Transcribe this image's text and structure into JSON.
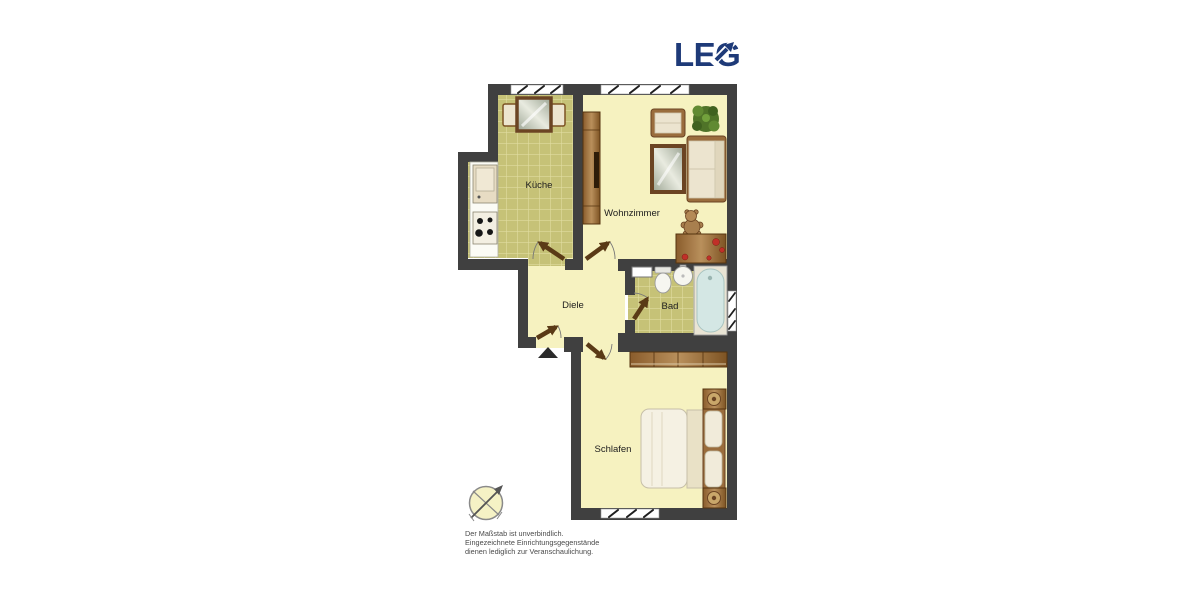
{
  "logo": {
    "text": "LEG",
    "color": "#1e3a78"
  },
  "floorplan": {
    "rooms": [
      {
        "id": "kueche",
        "label": "Küche"
      },
      {
        "id": "wohnzimmer",
        "label": "Wohnzimmer"
      },
      {
        "id": "diele",
        "label": "Diele"
      },
      {
        "id": "bad",
        "label": "Bad"
      },
      {
        "id": "schlafen",
        "label": "Schlafen"
      }
    ],
    "icons": {
      "compass": "north-arrow-compass-icon",
      "entrance": "entrance-direction-arrow"
    },
    "colors": {
      "wall": "#404040",
      "floor": "#f6f2c0",
      "tile_floor": "#c6c277",
      "tile_grid": "#e0dda0",
      "wood_dark": "#7d5323",
      "wood_light": "#b9905c",
      "door": "#5a3a16",
      "bathtub_water": "#d4e7e4",
      "plant_green": "#4f7328",
      "accent_red": "#c03028"
    }
  },
  "disclaimer": {
    "lines": [
      "Der Maßstab ist unverbindlich.",
      "Eingezeichnete Einrichtungsgegenstände",
      "dienen lediglich zur Veranschaulichung."
    ]
  }
}
